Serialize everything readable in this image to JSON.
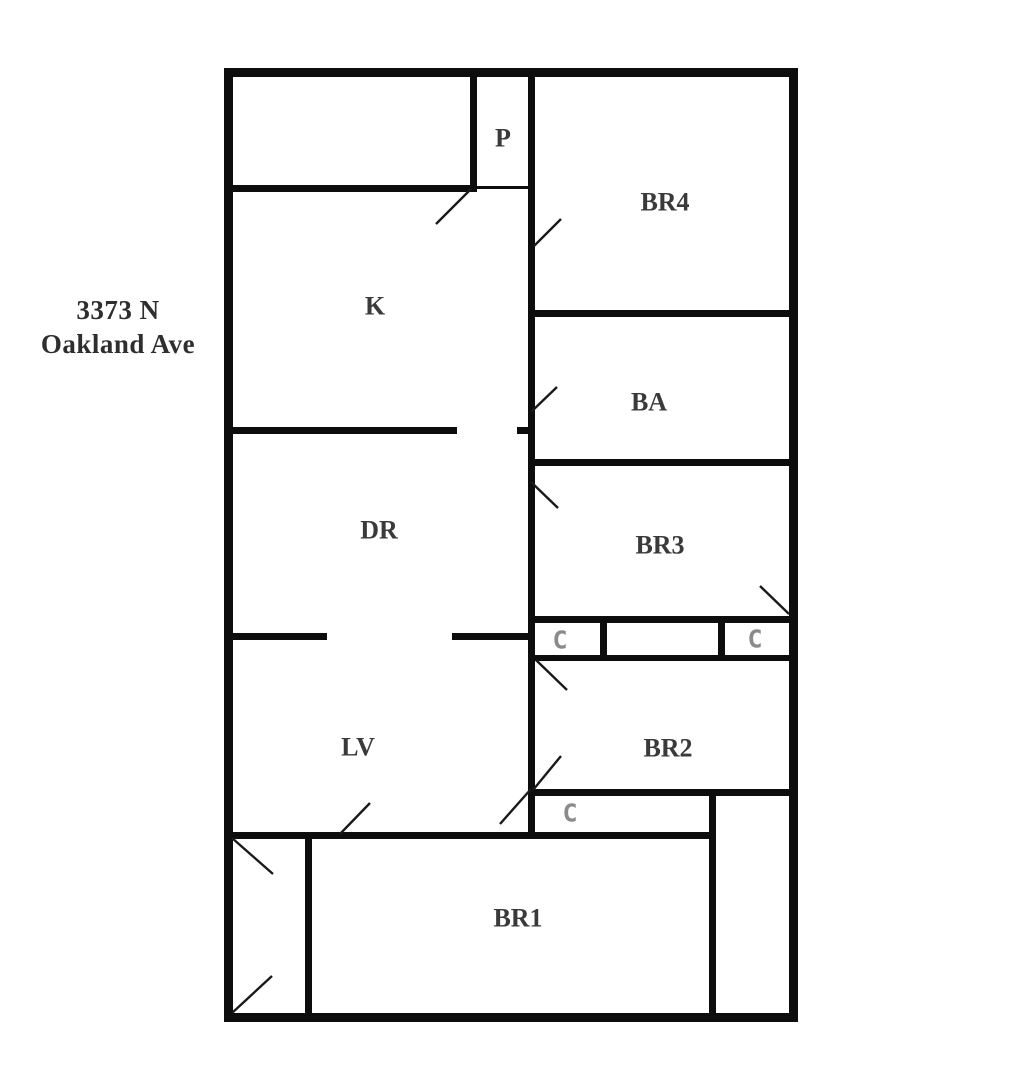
{
  "page": {
    "width": 1013,
    "height": 1080,
    "background": "#ffffff"
  },
  "address": {
    "line1": "3373 N",
    "line2": "Oakland Ave"
  },
  "colors": {
    "wall": "#0d0d0d",
    "door": "#1a1a1a",
    "room_label": "#3a3a3a",
    "closet_label": "#8a8a8a"
  },
  "floorplan": {
    "walls": [
      {
        "name": "outer-wall-top",
        "x": 224,
        "y": 68,
        "w": 574,
        "h": 9
      },
      {
        "name": "outer-wall-bottom",
        "x": 224,
        "y": 1013,
        "w": 574,
        "h": 9
      },
      {
        "name": "outer-wall-left",
        "x": 224,
        "y": 68,
        "w": 9,
        "h": 954
      },
      {
        "name": "outer-wall-right",
        "x": 789,
        "y": 68,
        "w": 9,
        "h": 954
      },
      {
        "name": "pantry-left-wall",
        "x": 470,
        "y": 77,
        "w": 7,
        "h": 115
      },
      {
        "name": "topleft-room-bottom-wall",
        "x": 233,
        "y": 185,
        "w": 244,
        "h": 7
      },
      {
        "name": "pantry-bottom-wall",
        "x": 477,
        "y": 186,
        "w": 51,
        "h": 3
      },
      {
        "name": "central-wall",
        "x": 528,
        "y": 77,
        "w": 7,
        "h": 762
      },
      {
        "name": "br4-ba-wall",
        "x": 535,
        "y": 310,
        "w": 254,
        "h": 7
      },
      {
        "name": "k-dr-wall-left",
        "x": 233,
        "y": 427,
        "w": 224,
        "h": 7
      },
      {
        "name": "k-dr-wall-right-tick",
        "x": 517,
        "y": 427,
        "w": 11,
        "h": 7
      },
      {
        "name": "ba-br3-wall",
        "x": 535,
        "y": 459,
        "w": 254,
        "h": 7
      },
      {
        "name": "br3-closetrow-wall",
        "x": 535,
        "y": 616,
        "w": 254,
        "h": 7
      },
      {
        "name": "closetrow-br2-wall",
        "x": 535,
        "y": 655,
        "w": 254,
        "h": 6
      },
      {
        "name": "closet-divider-1",
        "x": 600,
        "y": 623,
        "w": 7,
        "h": 32
      },
      {
        "name": "closet-divider-2",
        "x": 718,
        "y": 623,
        "w": 7,
        "h": 32
      },
      {
        "name": "dr-lv-wall-left",
        "x": 233,
        "y": 633,
        "w": 94,
        "h": 7
      },
      {
        "name": "dr-lv-wall-right",
        "x": 452,
        "y": 633,
        "w": 76,
        "h": 7
      },
      {
        "name": "br2-bottom-wall",
        "x": 535,
        "y": 789,
        "w": 254,
        "h": 7
      },
      {
        "name": "lv-br1-wall",
        "x": 233,
        "y": 832,
        "w": 483,
        "h": 7
      },
      {
        "name": "br1-right-wall",
        "x": 709,
        "y": 789,
        "w": 7,
        "h": 224
      },
      {
        "name": "vestibule-divider",
        "x": 305,
        "y": 839,
        "w": 7,
        "h": 174
      }
    ],
    "doors": [
      {
        "x1": 436,
        "y1": 224,
        "x2": 471,
        "y2": 189
      },
      {
        "x1": 534,
        "y1": 246,
        "x2": 561,
        "y2": 219
      },
      {
        "x1": 531,
        "y1": 412,
        "x2": 557,
        "y2": 387
      },
      {
        "x1": 531,
        "y1": 482,
        "x2": 558,
        "y2": 508
      },
      {
        "x1": 760,
        "y1": 586,
        "x2": 789,
        "y2": 614
      },
      {
        "x1": 536,
        "y1": 660,
        "x2": 567,
        "y2": 690
      },
      {
        "x1": 533,
        "y1": 790,
        "x2": 561,
        "y2": 756
      },
      {
        "x1": 500,
        "y1": 824,
        "x2": 531,
        "y2": 789
      },
      {
        "x1": 340,
        "y1": 834,
        "x2": 370,
        "y2": 803
      },
      {
        "x1": 232,
        "y1": 838,
        "x2": 273,
        "y2": 874
      },
      {
        "x1": 232,
        "y1": 1013,
        "x2": 272,
        "y2": 976
      }
    ],
    "rooms": [
      {
        "label": "P",
        "x": 503,
        "y": 138,
        "kind": "room"
      },
      {
        "label": "BR4",
        "x": 665,
        "y": 202,
        "kind": "room"
      },
      {
        "label": "K",
        "x": 375,
        "y": 306,
        "kind": "room"
      },
      {
        "label": "BA",
        "x": 649,
        "y": 402,
        "kind": "room"
      },
      {
        "label": "DR",
        "x": 379,
        "y": 530,
        "kind": "room"
      },
      {
        "label": "BR3",
        "x": 660,
        "y": 545,
        "kind": "room"
      },
      {
        "label": "C",
        "x": 560,
        "y": 640,
        "kind": "closet"
      },
      {
        "label": "C",
        "x": 755,
        "y": 639,
        "kind": "closet"
      },
      {
        "label": "LV",
        "x": 358,
        "y": 747,
        "kind": "room"
      },
      {
        "label": "BR2",
        "x": 668,
        "y": 748,
        "kind": "room"
      },
      {
        "label": "C",
        "x": 570,
        "y": 813,
        "kind": "closet"
      },
      {
        "label": "BR1",
        "x": 518,
        "y": 918,
        "kind": "room"
      }
    ]
  }
}
